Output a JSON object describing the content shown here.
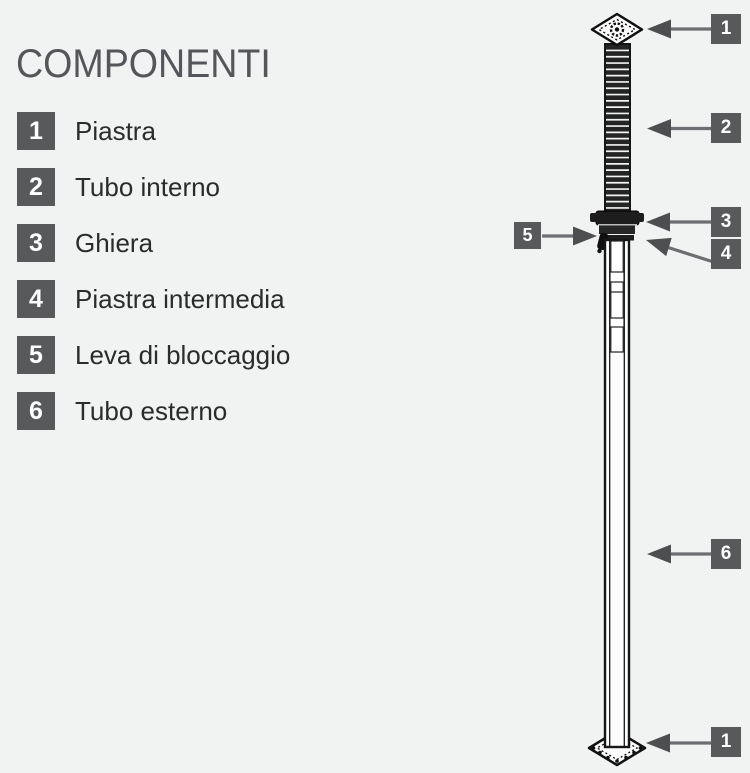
{
  "title": "COMPONENTI",
  "legend": [
    {
      "num": "1",
      "label": "Piastra"
    },
    {
      "num": "2",
      "label": "Tubo interno"
    },
    {
      "num": "3",
      "label": "Ghiera"
    },
    {
      "num": "4",
      "label": "Piastra intermedia"
    },
    {
      "num": "5",
      "label": "Leva di bloccaggio"
    },
    {
      "num": "6",
      "label": "Tubo esterno"
    }
  ],
  "callouts": [
    {
      "num": "1",
      "target": "top-plate"
    },
    {
      "num": "2",
      "target": "inner-tube"
    },
    {
      "num": "3",
      "target": "ghiera-collar"
    },
    {
      "num": "4",
      "target": "intermediate-plate"
    },
    {
      "num": "5",
      "target": "locking-lever"
    },
    {
      "num": "6",
      "target": "outer-tube"
    },
    {
      "num": "1",
      "target": "bottom-plate"
    }
  ],
  "colors": {
    "background": "#f1f2f2",
    "badge": "#58595b",
    "badge_text": "#ffffff",
    "arrow_line": "#6d6e71",
    "arrow_head": "#4d4e50",
    "title_text": "#55565a",
    "label_text": "#2b2b2b",
    "drawing_line": "#161616"
  }
}
